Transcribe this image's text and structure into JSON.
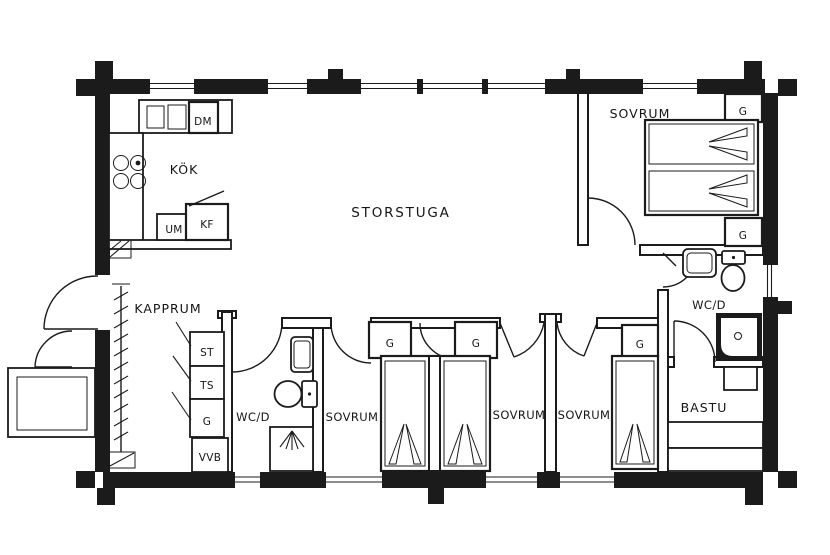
{
  "floor_plan": {
    "background": "#ffffff",
    "line_color": "#1b1b1b",
    "rooms": {
      "storstuga": "STORSTUGA",
      "kok": "KÖK",
      "kapprum": "KAPPRUM",
      "sovrum": "SOVRUM",
      "wcd": "WC/D",
      "bastu": "BASTU"
    },
    "closets": {
      "wardrobe": "G",
      "cleaning_cabinet": "ST",
      "drying_cabinet": "TS",
      "water_heater": "VVB"
    },
    "appliances": {
      "dishwasher": "DM",
      "oven": "UM",
      "fridge_freezer": "KF"
    }
  }
}
